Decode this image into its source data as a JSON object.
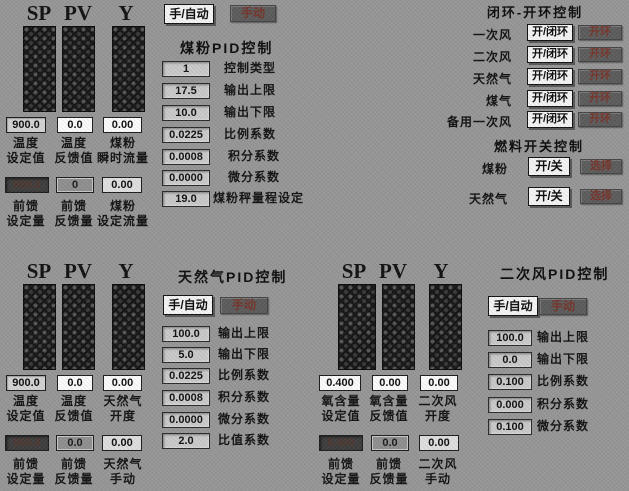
{
  "top_left": {
    "headers": [
      "SP",
      "PV",
      "Y"
    ],
    "values": [
      "900.0",
      "0.0",
      "0.00"
    ],
    "value_labels": [
      [
        "温度",
        "设定值"
      ],
      [
        "温度",
        "反馈值"
      ],
      [
        "煤粉",
        "瞬时流量"
      ]
    ],
    "ff_values": [
      "900.0",
      "0",
      "0.00"
    ],
    "ff_labels": [
      [
        "前馈",
        "设定量"
      ],
      [
        "前馈",
        "反馈量"
      ],
      [
        "煤粉",
        "设定流量"
      ]
    ]
  },
  "coal_pid": {
    "auto_button": "手/自动",
    "manual_button": "手动",
    "title": "煤粉PID控制",
    "rows": [
      {
        "value": "1",
        "label": "控制类型"
      },
      {
        "value": "17.5",
        "label": "输出上限"
      },
      {
        "value": "10.0",
        "label": "输出下限"
      },
      {
        "value": "0.0225",
        "label": "比例系数"
      },
      {
        "value": "0.0008",
        "label": "积分系数"
      },
      {
        "value": "0.0000",
        "label": "微分系数"
      },
      {
        "value": "19.0",
        "label": "煤粉秤量程设定"
      }
    ]
  },
  "loop_control": {
    "title": "闭环-开环控制",
    "toggle_label": "开/闭环",
    "action_label": "开环",
    "rows": [
      "一次风",
      "二次风",
      "天然气",
      "煤气",
      "备用一次风"
    ]
  },
  "fuel_switch": {
    "title": "燃料开关控制",
    "toggle_label": "开/关",
    "action_label": "选择",
    "rows": [
      "煤粉",
      "天然气"
    ]
  },
  "gas_bars": {
    "headers": [
      "SP",
      "PV",
      "Y"
    ],
    "values": [
      "900.0",
      "0.0",
      "0.00"
    ],
    "value_labels": [
      [
        "温度",
        "设定值"
      ],
      [
        "温度",
        "反馈值"
      ],
      [
        "天然气",
        "开度"
      ]
    ],
    "ff_values": [
      "900.0",
      "0.0",
      "0.00"
    ],
    "ff_labels": [
      [
        "前馈",
        "设定量"
      ],
      [
        "前馈",
        "反馈量"
      ],
      [
        "天然气",
        "手动"
      ]
    ]
  },
  "gas_pid": {
    "auto_button": "手/自动",
    "manual_button": "手动",
    "title": "天然气PID控制",
    "rows": [
      {
        "value": "100.0",
        "label": "输出上限"
      },
      {
        "value": "5.0",
        "label": "输出下限"
      },
      {
        "value": "0.0225",
        "label": "比例系数"
      },
      {
        "value": "0.0008",
        "label": "积分系数"
      },
      {
        "value": "0.0000",
        "label": "微分系数"
      },
      {
        "value": "2.0",
        "label": "比值系数"
      }
    ]
  },
  "o2_bars": {
    "headers": [
      "SP",
      "PV",
      "Y"
    ],
    "values": [
      "0.400",
      "0.00",
      "0.00"
    ],
    "value_labels": [
      [
        "氧含量",
        "设定值"
      ],
      [
        "氧含量",
        "反馈值"
      ],
      [
        "二次风",
        "开度"
      ]
    ],
    "ff_values": [
      "0.400",
      "0.0",
      "0.00"
    ],
    "ff_labels": [
      [
        "前馈",
        "设定量"
      ],
      [
        "前馈",
        "反馈量"
      ],
      [
        "二次风",
        "手动"
      ]
    ]
  },
  "air_pid": {
    "auto_button": "手/自动",
    "manual_button": "手动",
    "title": "二次风PID控制",
    "rows": [
      {
        "value": "100.0",
        "label": "输出上限"
      },
      {
        "value": "0.0",
        "label": "输出下限"
      },
      {
        "value": "0.100",
        "label": "比例系数"
      },
      {
        "value": "0.000",
        "label": "积分系数"
      },
      {
        "value": "0.100",
        "label": "微分系数"
      }
    ]
  }
}
